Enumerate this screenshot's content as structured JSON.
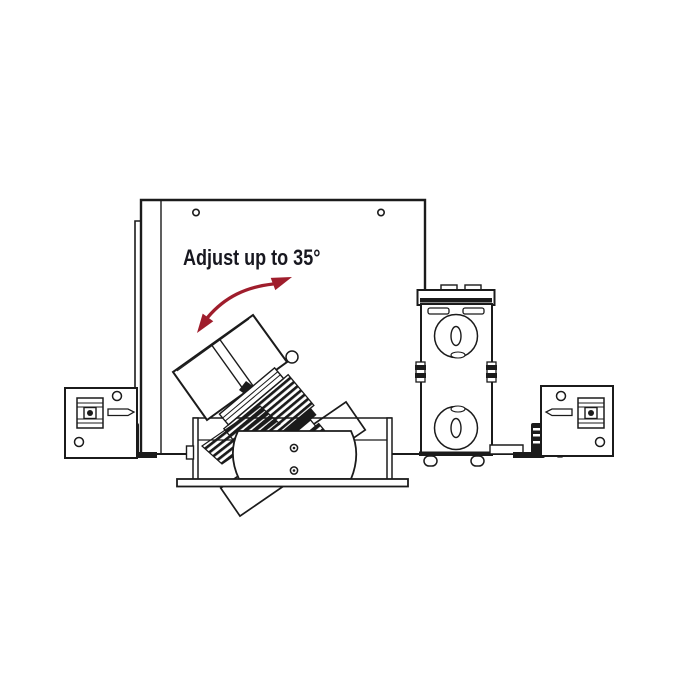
{
  "annotation": {
    "label": "Adjust up to 35°",
    "degrees": "35°"
  },
  "icons": {
    "adjustment_arrow": "curved-double-headed-arrow"
  },
  "colors": {
    "background": "#ffffff",
    "line": "#1b1b1b",
    "accent": "#9f1d2c",
    "text": "#181820"
  }
}
